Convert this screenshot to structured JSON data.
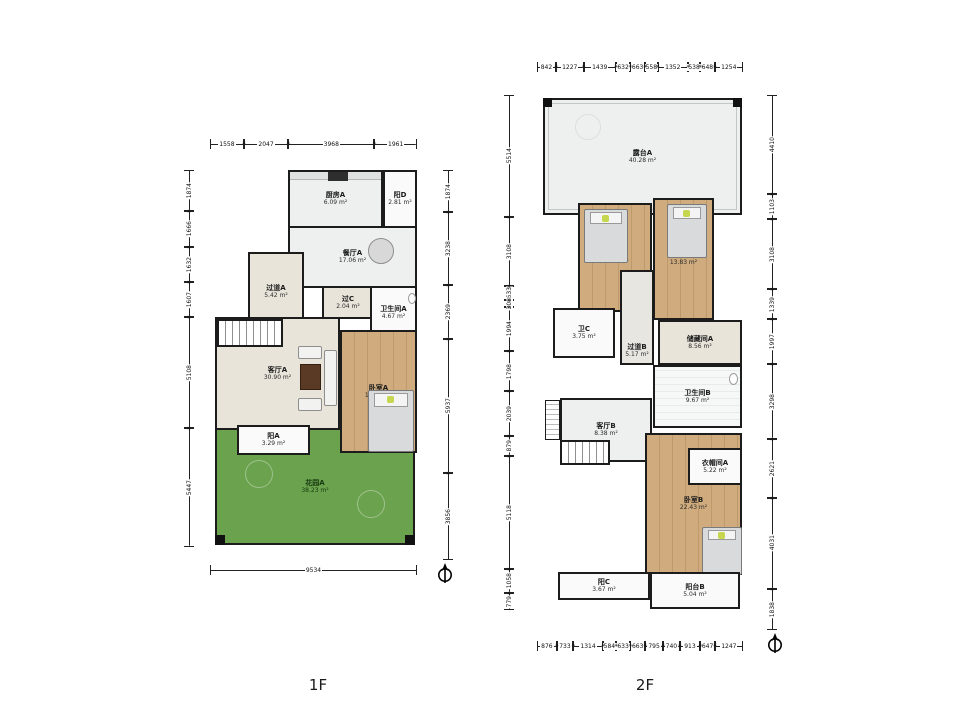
{
  "colors": {
    "wall": "#1c1c1c",
    "wood_floor": "#cfab7e",
    "beige_floor": "#e9e4da",
    "gray_floor": "#eef0f0",
    "garden_green": "#6ba24e",
    "background": "#ffffff"
  },
  "floors": [
    {
      "name": "1F",
      "rooms": [
        {
          "id": "kitchen-a",
          "label": "厨房A",
          "area": "6.09 m²"
        },
        {
          "id": "balcony-d",
          "label": "阳D",
          "area": "2.81 m²"
        },
        {
          "id": "dining-a",
          "label": "餐厅A",
          "area": "17.06 m²"
        },
        {
          "id": "hallway-a",
          "label": "过道A",
          "area": "5.42 m²"
        },
        {
          "id": "pass-c",
          "label": "过C",
          "area": "2.04 m²"
        },
        {
          "id": "bath-a",
          "label": "卫生间A",
          "area": "4.67 m²"
        },
        {
          "id": "living-a",
          "label": "客厅A",
          "area": "30.90 m²"
        },
        {
          "id": "bedroom-a",
          "label": "卧室A",
          "area": "19.13 m²"
        },
        {
          "id": "balcony-a",
          "label": "阳A",
          "area": "3.29 m²"
        },
        {
          "id": "garden-a",
          "label": "花园A",
          "area": "38.23 m²"
        }
      ],
      "dims": {
        "top": [
          "1558",
          "2047",
          "3968",
          "1961"
        ],
        "left": [
          "1874",
          "1666",
          "1632",
          "1607",
          "5108",
          "5447"
        ],
        "right": [
          "1874",
          "3238",
          "2369",
          "5937",
          "3856"
        ],
        "bottom": [
          "9534"
        ]
      }
    },
    {
      "name": "2F",
      "rooms": [
        {
          "id": "terrace-a",
          "label": "露台A",
          "area": "40.28 m²"
        },
        {
          "id": "bedroom-c",
          "label": "卧室C",
          "area": "11.87 m²"
        },
        {
          "id": "bedroom-d",
          "label": "卧室D",
          "area": "13.83 m²"
        },
        {
          "id": "bath-c",
          "label": "卫C",
          "area": "3.75 m²"
        },
        {
          "id": "hallway-b",
          "label": "过道B",
          "area": "5.17 m²"
        },
        {
          "id": "storage-a",
          "label": "储藏间A",
          "area": "8.56 m²"
        },
        {
          "id": "bath-b",
          "label": "卫生间B",
          "area": "9.67 m²"
        },
        {
          "id": "living-b",
          "label": "客厅B",
          "area": "8.38 m²"
        },
        {
          "id": "closet-a",
          "label": "衣帽间A",
          "area": "5.22 m²"
        },
        {
          "id": "bedroom-b",
          "label": "卧室B",
          "area": "22.43 m²"
        },
        {
          "id": "balcony-c",
          "label": "阳C",
          "area": "3.67 m²"
        },
        {
          "id": "balcony-b",
          "label": "阳台B",
          "area": "5.04 m²"
        }
      ],
      "dims": {
        "top": [
          "842",
          "1227",
          "1439",
          "632",
          "663",
          "558",
          "1352",
          "538",
          "648",
          "1254"
        ],
        "left": [
          "5514",
          "3108",
          "633",
          "308",
          "1994",
          "1798",
          "2039",
          "879",
          "5118",
          "1058",
          "779"
        ],
        "right": [
          "4410",
          "1103",
          "3108",
          "1339",
          "1997",
          "3298",
          "2621",
          "4031",
          "1838"
        ],
        "bottom": [
          "876",
          "733",
          "1314",
          "584",
          "633",
          "663",
          "795",
          "740",
          "913",
          "647",
          "1247"
        ]
      }
    }
  ]
}
